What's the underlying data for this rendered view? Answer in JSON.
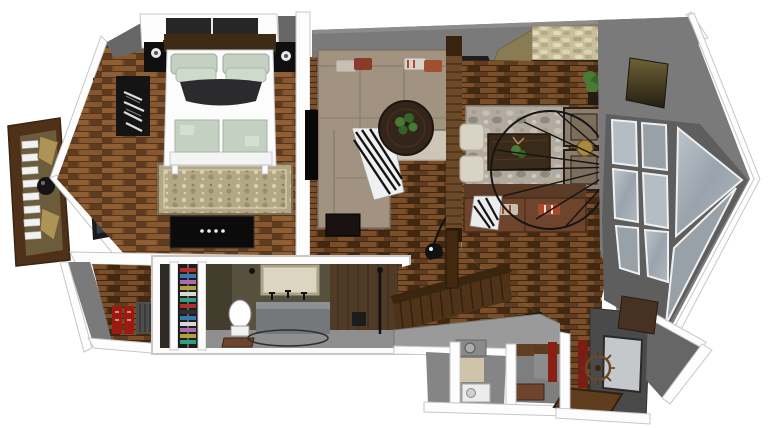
{
  "meta": {
    "title": "3D cutaway floor plan render of a loft apartment",
    "view": "top-down dollhouse section, sketch-render style",
    "visible_text": "none"
  },
  "palette": {
    "bg": "#ffffff",
    "wall": "#7a7a7a",
    "wallD": "#666666",
    "wallDD": "#4a4a4a",
    "trim": "#fdfdfd",
    "trimEdge": "#c7c7c7",
    "wood": "#7a4e29",
    "woodLight": "#8f5e33",
    "woodDark": "#5f3b20",
    "woodDeep": "#42280f",
    "woodFrame": "#4f3119",
    "stone": "#cabf9c",
    "stoneDark": "#a89d78",
    "tan": "#8a7c52",
    "sofaTaupe": "#a29380",
    "sofaTaupeDark": "#7d7164",
    "rugLiving": "#cdc6b8",
    "rugBed": "#b3a785",
    "rugBedDark": "#7c7050",
    "rugDining": "#b2aa9e",
    "leather": "#6e452c",
    "leatherDark": "#4a2c18",
    "glass": "#b4bcc4",
    "glassDark": "#98a0a8",
    "glassNight": "#39424a",
    "bathWall": "#57503e",
    "bathWallDark": "#433d2e",
    "bathFloor": "#8f8f8f",
    "vanity": "#74787a",
    "mirror": "#dcd5bf",
    "sage": "#c3d0c2",
    "sageDark": "#a3b3a3",
    "black": "#111111",
    "red": "#9c1a12",
    "redCurtain": "#7a1d14",
    "green": "#4a7a34",
    "greenDark": "#356426",
    "matBrown": "#5f3d1f",
    "slabGray": "#9a9a9a",
    "white": "#fcfcfc"
  },
  "objects": {
    "balcony": "balcony deck with two chairs and round table",
    "bedroom": "bedroom with double bed, nightstands, rug, media console",
    "living": "living room with sectional sofa, round coffee table, rug",
    "dining": "dining lounge with table, armchairs, leather sofa, wheel fan",
    "fireplace": "stone chimney block at top wall",
    "bayWindow": "angled bay window wall with paned glass",
    "bathroom": "sectioned bathroom with toilet, vanity, mirror",
    "closet": "closet with shoe rack and red books",
    "stairs": "wood staircase with balustrade and handrail",
    "laundry": "lower level utility rooms with washer",
    "entry": "entry hall with window, wreath and door mat"
  }
}
